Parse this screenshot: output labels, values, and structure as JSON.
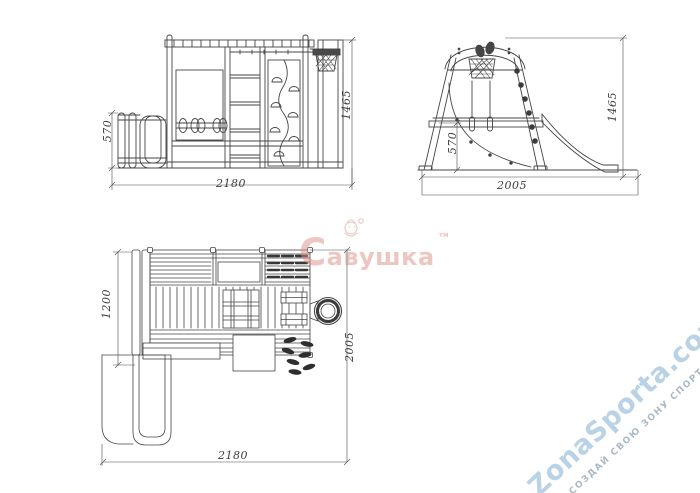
{
  "page": {
    "background": "#ffffff"
  },
  "views": {
    "front": {
      "name": "front-elevation",
      "dims": {
        "height_slide": "570",
        "width": "2180",
        "height_total": "1465"
      }
    },
    "side": {
      "name": "side-elevation",
      "dims": {
        "height_platform": "570",
        "width": "2005",
        "height_total": "1465"
      }
    },
    "plan": {
      "name": "top-plan",
      "dims": {
        "depth_frame": "1200",
        "width": "2180",
        "depth_total": "2005"
      }
    }
  },
  "watermarks": {
    "brand": {
      "text": "Савушка",
      "tm": "тм",
      "color": "#dd8d85"
    },
    "site": {
      "text": "ZonaSporta.com",
      "tagline": "СОЗДАЙ СВОЮ ЗОНУ СПОРТА",
      "color": "#a9c8e1",
      "tagline_color": "#9badbb"
    }
  },
  "drawing": {
    "line_color": "#454545",
    "dim_color": "#4a4a4a"
  }
}
